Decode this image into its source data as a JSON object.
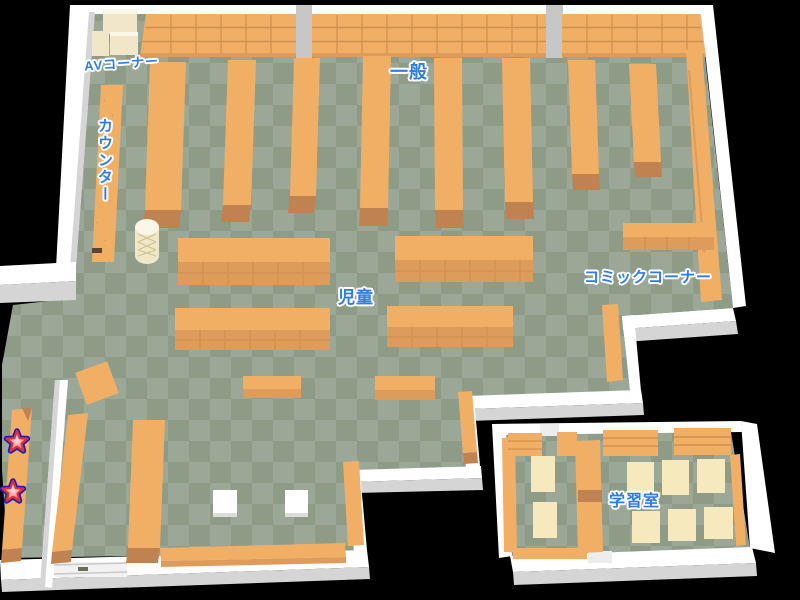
{
  "map": {
    "name": "library-floor-map",
    "labels": {
      "av_corner": "AVコーナー",
      "counter": "カウンター",
      "general": "一般",
      "children": "児童",
      "comic_corner": "コミックコーナー",
      "study_room": "学習室"
    },
    "markers": {
      "count": 2,
      "shape": "star"
    },
    "palette": {
      "background": "#000000",
      "floor_light": "#9ca897",
      "floor_dark": "#8d9b87",
      "shelf_light": "#f1af66",
      "shelf_mid": "#dd9c5b",
      "shelf_dark": "#c08250",
      "shelf_line": "#cf9051",
      "wall_white": "#ffffff",
      "wall_gray": "#d5d5d5",
      "wall_gray2": "#c7c7c7",
      "cream": "#f0e7c8",
      "cream_top": "#faf6e8",
      "table_cream": "#f6e9bd",
      "label_blue": "#2e7ce8",
      "star_fill_outer": "#ee6666",
      "star_fill_inner": "#ffe0e0",
      "star_ring_red": "#e23030",
      "star_ring_blue": "#1d1dbb"
    }
  }
}
